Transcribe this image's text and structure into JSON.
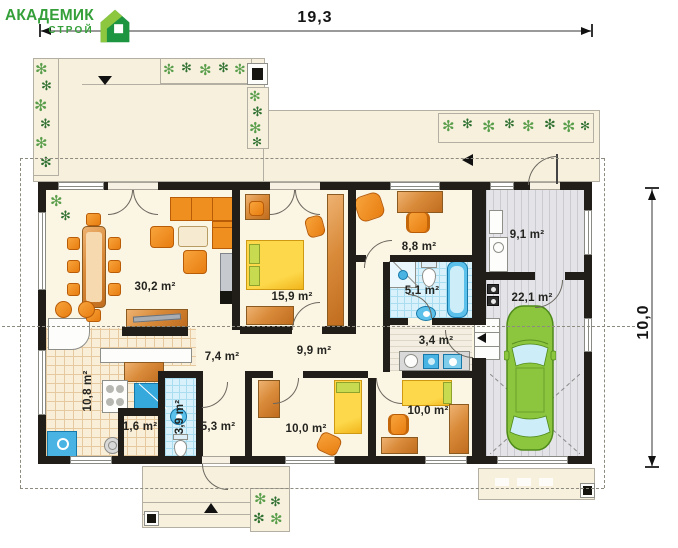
{
  "logo": {
    "title": "АКАДЕМИК",
    "subtitle": "СТРОЙ"
  },
  "dimensions": {
    "width_label": "19,3",
    "height_label": "10,0"
  },
  "rooms": [
    {
      "name": "living-room",
      "area": "30,2 m²"
    },
    {
      "name": "bedroom-master",
      "area": "15,9 m²"
    },
    {
      "name": "study",
      "area": "8,8 m²"
    },
    {
      "name": "boiler-room",
      "area": "9,1 m²"
    },
    {
      "name": "bathroom",
      "area": "5,1 m²"
    },
    {
      "name": "garage",
      "area": "22,1 m²"
    },
    {
      "name": "mudroom",
      "area": "3,4 m²"
    },
    {
      "name": "hallway",
      "area": "7,4 m²"
    },
    {
      "name": "corridor",
      "area": "9,9 m²"
    },
    {
      "name": "kitchen",
      "area": "10,8 m²"
    },
    {
      "name": "pantry",
      "area": "1,6 m²"
    },
    {
      "name": "wc",
      "area": "3,9 m²"
    },
    {
      "name": "entry-hall",
      "area": "5,3 m²"
    },
    {
      "name": "bedroom-left",
      "area": "10,0 m²"
    },
    {
      "name": "bedroom-right",
      "area": "10,0 m²"
    }
  ],
  "icons": {
    "plant": "✻"
  },
  "colors": {
    "brand_green": "#35a03a",
    "brand_light_green": "#8dc63f",
    "wall": "#211d19",
    "furniture_orange": "#ef8f1f",
    "wood": "#d98b3a",
    "bed_yellow": "#fdd84a",
    "pillow_green": "#c8da50",
    "water_blue": "#49b4e3",
    "tile_blue": "#d8f1fa",
    "floor_cream": "#fbf5e3",
    "terrace_beige": "#f6f0dd",
    "floor_gray": "#e4e4e8",
    "car_green": "#8cc63e"
  }
}
